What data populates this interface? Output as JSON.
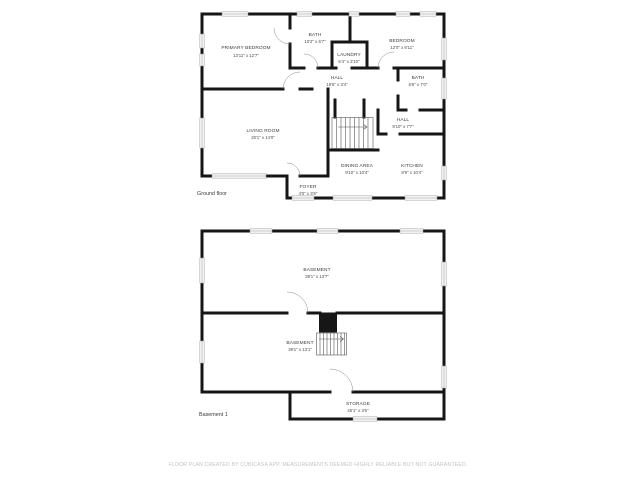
{
  "colors": {
    "wall": "#161616",
    "window_fill": "#f5f5f5",
    "window_stroke": "#a3a3a3",
    "label_text": "#3c3c3c",
    "floor_label_text": "#3a3a3a",
    "disclaimer_text": "#c3c3c3",
    "background": "#ffffff"
  },
  "ground_floor": {
    "floor_label": "Ground floor",
    "rooms": {
      "primary_bedroom": {
        "name": "PRIMARY BEDROOM",
        "dims": "13'11\" x 12'7\""
      },
      "bath_top": {
        "name": "BATH",
        "dims": "10'2\" x 6'7\""
      },
      "laundry": {
        "name": "LAUNDRY",
        "dims": "5'4\" x 3'10\""
      },
      "bedroom": {
        "name": "BEDROOM",
        "dims": "12'0\" x 8'11\""
      },
      "hall_top": {
        "name": "HALL",
        "dims": "19'6\" x 3'4\""
      },
      "bath_right": {
        "name": "BATH",
        "dims": "6'6\" x 7'0\""
      },
      "hall_right": {
        "name": "HALL",
        "dims": "9'10\" x 7'7\""
      },
      "living_room": {
        "name": "LIVING ROOM",
        "dims": "20'1\" x 14'0\""
      },
      "dining_area": {
        "name": "DINING AREA",
        "dims": "9'10\" x 10'4\""
      },
      "kitchen": {
        "name": "KITCHEN",
        "dims": "8'9\" x 10'4\""
      },
      "foyer": {
        "name": "FOYER",
        "dims": "4'0\" x 3'6\""
      }
    }
  },
  "basement_floor": {
    "floor_label": "Basement 1",
    "rooms": {
      "basement_main": {
        "name": "BASEMENT",
        "dims": "39'1\" x 13'7\""
      },
      "basement_lower": {
        "name": "BASEMENT",
        "dims": "39'1\" x 13'1\""
      },
      "storage": {
        "name": "STORAGE",
        "dims": "25'1\" x 3'6\""
      }
    }
  },
  "footer": {
    "disclaimer": "FLOOR PLAN CREATED BY CUBICASA APP. MEASUREMENTS DEEMED HIGHLY RELIABLE BUT NOT GUARANTEED."
  }
}
